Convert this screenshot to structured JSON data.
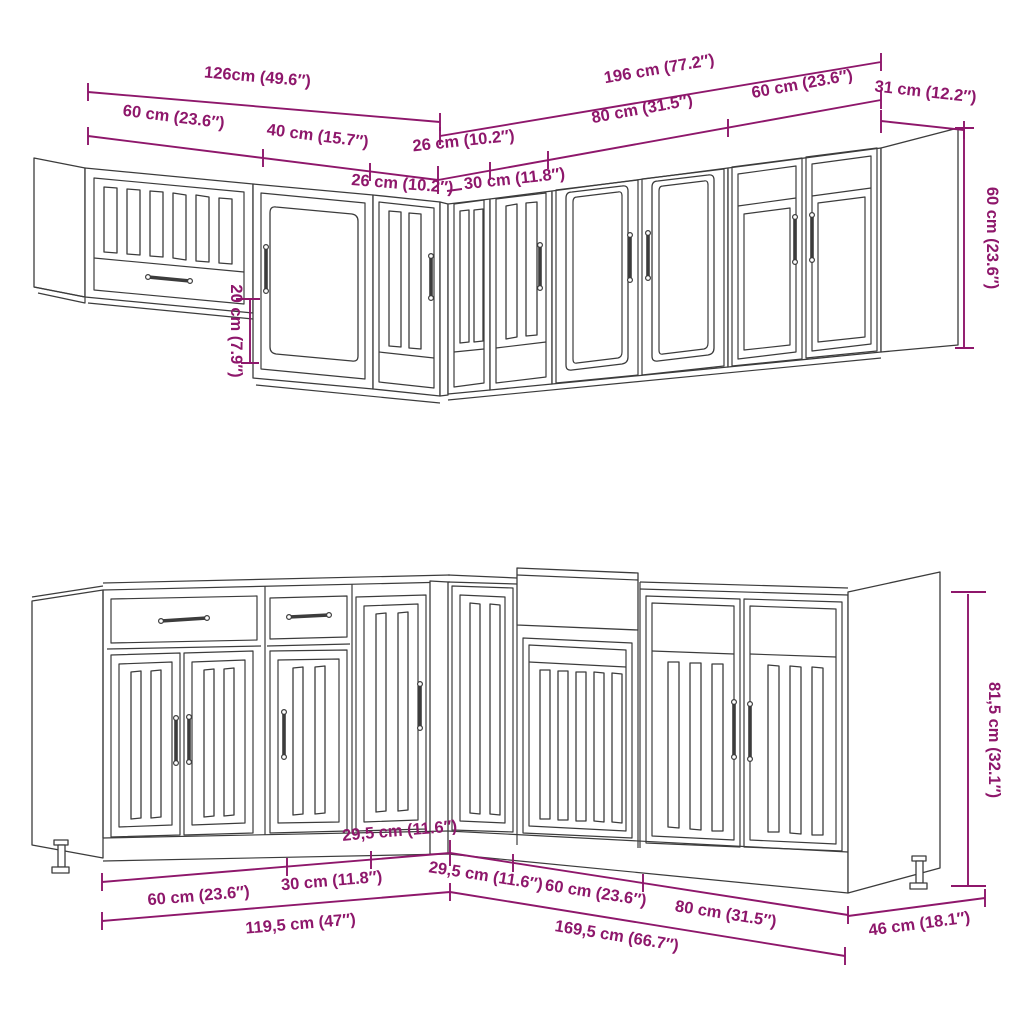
{
  "colors": {
    "dimension": "#8e176b",
    "linework": "#3c3c3c",
    "background": "#ffffff"
  },
  "dimensions": {
    "top": {
      "total_left_run": "126cm (49.6″)",
      "total_right_run": "196 cm (77.2″)",
      "side_depth": "31 cm (12.2″)",
      "wall_60_left": "60 cm (23.6″)",
      "wall_40": "40 cm (15.7″)",
      "wall_26_left": "26 cm (10.2″)",
      "wall_26_right": "26 cm (10.2″)",
      "wall_30": "30 cm (11.8″)",
      "wall_80": "80 cm (31.5″)",
      "wall_60_right": "60 cm (23.6″)",
      "wall_height": "60 cm (23.6″)",
      "wall_height_offset": "20 cm (7.9″)"
    },
    "bottom": {
      "corner_left": "29,5 cm (11.6″)",
      "corner_right": "29,5 cm (11.6″)",
      "base_60_left": "60 cm (23.6″)",
      "base_30": "30 cm (11.8″)",
      "base_60_sink": "60 cm (23.6″)",
      "base_80": "80 cm (31.5″)",
      "total_left_run": "119,5 cm (47″)",
      "total_right_run": "169,5 cm (66.7″)",
      "side_depth": "46 cm (18.1″)",
      "base_height": "81,5 cm (32.1″)"
    }
  }
}
